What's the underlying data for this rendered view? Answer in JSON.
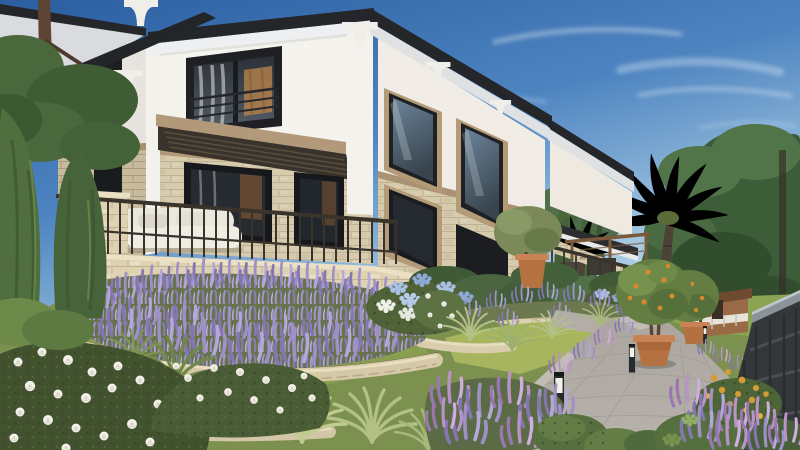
{
  "scene": {
    "type": "architectural-render",
    "subject": "two-story modern villa with stone base and terraced mediterranean garden",
    "lighting": "clear blue sky, warm late-afternoon sun from the right",
    "objects": [
      "villa",
      "hip-roof-with-corbels",
      "balcony-railing",
      "louvered-canopy",
      "terrace",
      "stone-retaining-walls",
      "lavender-beds",
      "white-rose-bushes",
      "hydrangeas",
      "ornamental-grasses",
      "lawn",
      "paver-path",
      "path-bollard-lights",
      "potted-citrus-trees",
      "terracotta-pots",
      "palm-trees",
      "pine-trees",
      "cypress-trees",
      "garden-fence",
      "pergola",
      "playhouse",
      "outdoor-sofa"
    ]
  },
  "palette": {
    "sky_top": "#2b5ea1",
    "sky_mid": "#4d84c0",
    "sky_low": "#9fc4e0",
    "sky_horizon": "#d9e9f1",
    "cloud": "#ffffff",
    "roof": "#25262a",
    "soffit": "#edeff1",
    "soffit_shade": "#d9dbde",
    "corbel": "#f0eee9",
    "wall_white": "#f5f3ee",
    "wall_shade": "#e7e4df",
    "wall_right": "#f1ede6",
    "stone_base": "#d7cbae",
    "stone_shade": "#c8bb9d",
    "trim_tan": "#b2997a",
    "frame_dark": "#1e2023",
    "glass_top": "#2c3138",
    "glass_bottom": "#525c66",
    "glass_sky": "#6c849a",
    "interior_warm": "#b5824c",
    "curtain": "#e8e6e2",
    "railing": "#39332c",
    "terrace_stone": "#ded2b2",
    "plaster": "#dbd2c6",
    "step": "#d6d0c2",
    "ground": "#7c914f",
    "lawn": "#8a9e52",
    "lawn_sun": "#a6b55e",
    "foliage_dark": "#3d5c38",
    "foliage_mid": "#517449",
    "foliage_light": "#6f8b52",
    "conifer": "#506e3e",
    "pine": "#4a683c",
    "trunk": "#5d4434",
    "lavender": "#9f90c8",
    "lavender_dark": "#8576b0",
    "lavender_light": "#b4a8da",
    "lavender_base": "#66734d",
    "lavender_pink": "#b993c8",
    "rose_white": "#f3f2ec",
    "rose_leaf": "#42522f",
    "hyd_blue": "#a9c0e4",
    "hyd_blue_dark": "#8fa9d6",
    "hyd_white": "#eef0ea",
    "grass_sage": "#b4c186",
    "path": "#b7b2ab",
    "path_joint": "#a29d96",
    "terracotta": "#b5713f",
    "terracotta_light": "#c98354",
    "citrus": "#647d42",
    "orange": "#d98a2e",
    "bollard": "#282b2d",
    "bollard_glow": "#f1f1e6",
    "fence": "#33373a",
    "fence_cap": "#8b9298",
    "marigold": "#d79b36",
    "palm": "#a8bd6e",
    "palm_light": "#c2d387",
    "palm_dark": "#7f9a54",
    "playhouse_roof": "#6e4a30",
    "playhouse_wall": "#9a6a46"
  }
}
